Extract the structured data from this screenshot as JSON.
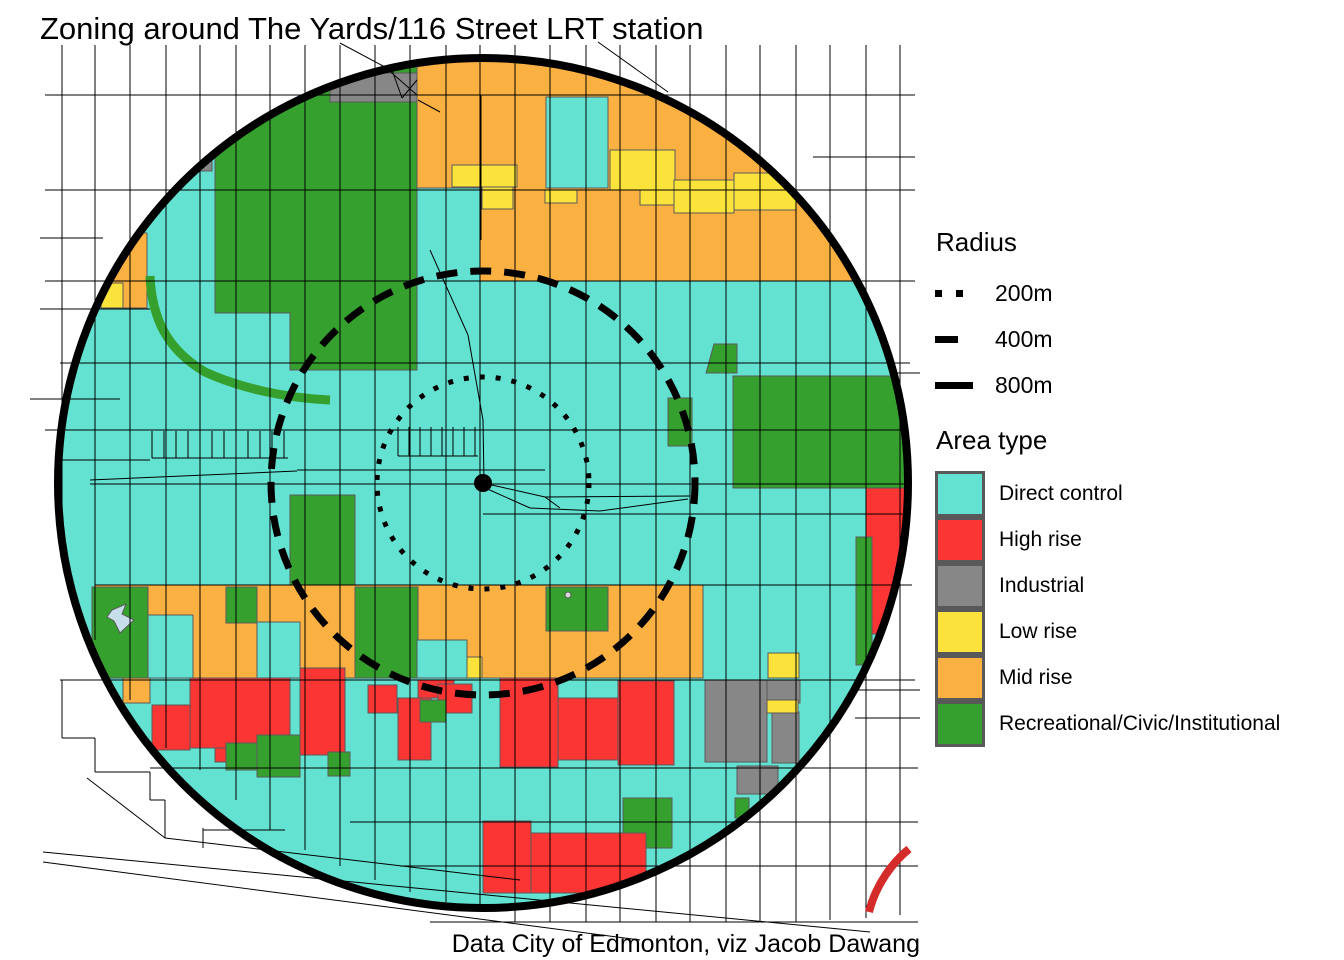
{
  "title": "Zoning around The Yards/116 Street LRT station",
  "caption": "Data City of Edmonton, viz Jacob Dawang",
  "colors": {
    "dc": "#63E2D2",
    "hr": "#FB3434",
    "ind": "#878787",
    "lr": "#FBE33C",
    "mr": "#FBB042",
    "rec": "#36A02F",
    "water": "#C7DFEA",
    "white_dot": "#D9D9D9",
    "red_line": "#D42B2B",
    "parcel_stroke": "#5a5a5a",
    "street": "#000000",
    "ring": "#000000"
  },
  "legend": {
    "radius": {
      "title": "Radius",
      "items": [
        {
          "label": "200m",
          "style": "dotted"
        },
        {
          "label": "400m",
          "style": "dashed"
        },
        {
          "label": "800m",
          "style": "solid"
        }
      ]
    },
    "area_type": {
      "title": "Area type",
      "items": [
        {
          "label": "Direct control",
          "key": "dc"
        },
        {
          "label": "High rise",
          "key": "hr"
        },
        {
          "label": "Industrial",
          "key": "ind"
        },
        {
          "label": "Low rise",
          "key": "lr"
        },
        {
          "label": "Mid rise",
          "key": "mr"
        },
        {
          "label": "Recreational/Civic/Institutional",
          "key": "rec"
        }
      ]
    }
  },
  "map": {
    "center": {
      "x": 483,
      "y": 483
    },
    "rings": [
      {
        "name": "200m",
        "r": 106,
        "w": 5,
        "dash": "5 11"
      },
      {
        "name": "400m",
        "r": 212,
        "w": 7,
        "dash": "21 13"
      },
      {
        "name": "800m",
        "r": 425,
        "w": 8,
        "dash": ""
      }
    ],
    "center_dot_r": 9,
    "base": "dc",
    "parcels": [
      {
        "pts": "215,60 417,60 417,370 290,370 290,313 215,313",
        "c": "rec"
      },
      {
        "r": [
          330,
          73,
          87,
          29
        ],
        "c": "ind"
      },
      {
        "r": [
          196,
          155,
          16,
          16
        ],
        "c": "ind"
      },
      {
        "pts": "101,233 147,233 147,308 123,308 123,283 101,283",
        "c": "mr"
      },
      {
        "r": [
          101,
          283,
          22,
          25
        ],
        "c": "lr"
      },
      {
        "path": "M150,276 C152,320 168,350 205,372 C240,388 285,398 330,400",
        "stroke": "rec",
        "w": 9
      },
      {
        "pts": "417,50 905,50 905,281 480,281 480,188 417,188",
        "c": "mr"
      },
      {
        "r": [
          546,
          97,
          62,
          91
        ],
        "c": "dc"
      },
      {
        "r": [
          452,
          165,
          65,
          22
        ],
        "c": "lr"
      },
      {
        "r": [
          482,
          187,
          31,
          22
        ],
        "c": "lr"
      },
      {
        "r": [
          545,
          190,
          32,
          13
        ],
        "c": "lr"
      },
      {
        "r": [
          610,
          150,
          65,
          40
        ],
        "c": "lr"
      },
      {
        "r": [
          640,
          190,
          35,
          15
        ],
        "c": "lr"
      },
      {
        "r": [
          674,
          180,
          60,
          33
        ],
        "c": "lr"
      },
      {
        "r": [
          734,
          173,
          62,
          37
        ],
        "c": "lr"
      },
      {
        "pts": "714,344 737,344 737,373 706,373",
        "c": "rec"
      },
      {
        "r": [
          733,
          376,
          175,
          112
        ],
        "c": "rec"
      },
      {
        "r": [
          668,
          398,
          24,
          48
        ],
        "c": "rec"
      },
      {
        "r": [
          866,
          488,
          42,
          146
        ],
        "c": "hr"
      },
      {
        "r": [
          856,
          537,
          16,
          128
        ],
        "c": "rec"
      },
      {
        "r": [
          290,
          495,
          65,
          92
        ],
        "c": "rec"
      },
      {
        "r": [
          95,
          585,
          608,
          93
        ],
        "c": "mr"
      },
      {
        "r": [
          92,
          587,
          56,
          91
        ],
        "c": "rec"
      },
      {
        "r": [
          148,
          615,
          45,
          63
        ],
        "c": "dc"
      },
      {
        "r": [
          226,
          587,
          31,
          36
        ],
        "c": "rec"
      },
      {
        "r": [
          257,
          622,
          43,
          56
        ],
        "c": "dc"
      },
      {
        "r": [
          355,
          587,
          63,
          91
        ],
        "c": "rec"
      },
      {
        "r": [
          417,
          640,
          50,
          38
        ],
        "c": "dc"
      },
      {
        "r": [
          467,
          657,
          15,
          21
        ],
        "c": "lr"
      },
      {
        "r": [
          546,
          587,
          62,
          44
        ],
        "c": "rec"
      },
      {
        "r": [
          768,
          653,
          31,
          25
        ],
        "c": "lr"
      },
      {
        "r": [
          123,
          678,
          27,
          25
        ],
        "c": "mr"
      },
      {
        "r": [
          152,
          705,
          38,
          45
        ],
        "c": "hr"
      },
      {
        "r": [
          190,
          678,
          100,
          70
        ],
        "c": "hr"
      },
      {
        "r": [
          215,
          748,
          85,
          14
        ],
        "c": "hr"
      },
      {
        "r": [
          300,
          668,
          45,
          87
        ],
        "c": "hr"
      },
      {
        "r": [
          368,
          685,
          29,
          28
        ],
        "c": "hr"
      },
      {
        "r": [
          398,
          698,
          33,
          62
        ],
        "c": "hr"
      },
      {
        "r": [
          418,
          680,
          36,
          18
        ],
        "c": "hr"
      },
      {
        "r": [
          438,
          684,
          34,
          29
        ],
        "c": "hr"
      },
      {
        "r": [
          500,
          678,
          58,
          89
        ],
        "c": "hr"
      },
      {
        "r": [
          558,
          698,
          60,
          62
        ],
        "c": "hr"
      },
      {
        "r": [
          618,
          681,
          56,
          84
        ],
        "c": "hr"
      },
      {
        "r": [
          226,
          743,
          31,
          27
        ],
        "c": "rec"
      },
      {
        "r": [
          257,
          735,
          43,
          42
        ],
        "c": "rec"
      },
      {
        "r": [
          420,
          700,
          26,
          22
        ],
        "c": "rec"
      },
      {
        "r": [
          328,
          752,
          22,
          24
        ],
        "c": "rec"
      },
      {
        "r": [
          705,
          680,
          62,
          82
        ],
        "c": "ind"
      },
      {
        "r": [
          767,
          680,
          33,
          23
        ],
        "c": "ind"
      },
      {
        "r": [
          772,
          712,
          27,
          51
        ],
        "c": "ind"
      },
      {
        "r": [
          737,
          766,
          41,
          28
        ],
        "c": "ind"
      },
      {
        "r": [
          767,
          700,
          31,
          13
        ],
        "c": "lr"
      },
      {
        "r": [
          623,
          798,
          49,
          50
        ],
        "c": "rec"
      },
      {
        "r": [
          735,
          798,
          14,
          20
        ],
        "c": "rec"
      },
      {
        "r": [
          483,
          821,
          48,
          72
        ],
        "c": "hr"
      },
      {
        "r": [
          531,
          833,
          115,
          60
        ],
        "c": "hr"
      }
    ],
    "water_marker_pts": "112,610 126,604 122,614 134,620 120,633 114,621 107,617",
    "white_dot": [
      568,
      595,
      3
    ],
    "red_curve": "M909,849 C893,862 876,884 869,912",
    "streets": [
      [
        62,
        45,
        62,
        540
      ],
      [
        95,
        45,
        95,
        640
      ],
      [
        130,
        45,
        130,
        700
      ],
      [
        166,
        45,
        166,
        748
      ],
      [
        200,
        45,
        200,
        770
      ],
      [
        236,
        45,
        236,
        800
      ],
      [
        270,
        45,
        270,
        830
      ],
      [
        305,
        45,
        305,
        850
      ],
      [
        340,
        45,
        340,
        866
      ],
      [
        375,
        45,
        375,
        880
      ],
      [
        410,
        45,
        410,
        892
      ],
      [
        446,
        45,
        446,
        902
      ],
      [
        480,
        45,
        480,
        912
      ],
      [
        515,
        45,
        515,
        922
      ],
      [
        550,
        45,
        550,
        922
      ],
      [
        586,
        45,
        586,
        922
      ],
      [
        620,
        45,
        620,
        922
      ],
      [
        656,
        45,
        656,
        922
      ],
      [
        690,
        45,
        690,
        922
      ],
      [
        726,
        45,
        726,
        922
      ],
      [
        760,
        45,
        760,
        922
      ],
      [
        796,
        45,
        796,
        922
      ],
      [
        830,
        45,
        830,
        920
      ],
      [
        866,
        45,
        866,
        918
      ],
      [
        900,
        45,
        900,
        915
      ],
      [
        45,
        95,
        915,
        95
      ],
      [
        45,
        190,
        915,
        190
      ],
      [
        45,
        281,
        915,
        281
      ],
      [
        60,
        363,
        910,
        363
      ],
      [
        45,
        430,
        905,
        430
      ],
      [
        297,
        470,
        545,
        470
      ],
      [
        90,
        480,
        297,
        471
      ],
      [
        90,
        484,
        908,
        484
      ],
      [
        483,
        514,
        906,
        514
      ],
      [
        95,
        585,
        912,
        585
      ],
      [
        60,
        680,
        915,
        680
      ],
      [
        150,
        768,
        918,
        768
      ],
      [
        350,
        822,
        918,
        822
      ],
      [
        400,
        866,
        918,
        866
      ],
      [
        813,
        157,
        915,
        157
      ],
      [
        895,
        373,
        920,
        373
      ],
      [
        858,
        690,
        920,
        690
      ],
      [
        855,
        718,
        920,
        718
      ],
      [
        430,
        922,
        918,
        922
      ],
      [
        40,
        238,
        103,
        238
      ],
      [
        40,
        309,
        150,
        309
      ],
      [
        30,
        399,
        120,
        399
      ],
      [
        60,
        460,
        150,
        460
      ],
      [
        340,
        43,
        385,
        67
      ],
      [
        385,
        67,
        417,
        95
      ],
      [
        392,
        70,
        402,
        98
      ],
      [
        402,
        98,
        417,
        80
      ],
      [
        418,
        100,
        440,
        112
      ],
      [
        598,
        42,
        668,
        92
      ],
      [
        481,
        95,
        481,
        240
      ],
      [
        430,
        250,
        468,
        335
      ],
      [
        468,
        335,
        483,
        420
      ],
      [
        483,
        420,
        484,
        483
      ],
      [
        483,
        483,
        545,
        497
      ],
      [
        545,
        497,
        690,
        496
      ],
      [
        483,
        487,
        530,
        508
      ],
      [
        530,
        508,
        600,
        511
      ],
      [
        600,
        511,
        688,
        499
      ],
      [
        545,
        497,
        560,
        508
      ],
      [
        62,
        680,
        62,
        738
      ],
      [
        62,
        738,
        95,
        738
      ],
      [
        95,
        738,
        95,
        772
      ],
      [
        95,
        772,
        150,
        772
      ],
      [
        150,
        772,
        150,
        800
      ],
      [
        150,
        800,
        165,
        800
      ],
      [
        165,
        800,
        165,
        838
      ],
      [
        87,
        778,
        165,
        838
      ],
      [
        203,
        828,
        203,
        848
      ],
      [
        203,
        830,
        285,
        830
      ],
      [
        43,
        852,
        870,
        932
      ],
      [
        43,
        862,
        640,
        940
      ],
      [
        165,
        838,
        520,
        880
      ],
      [
        152,
        458,
        288,
        458
      ],
      [
        398,
        456,
        478,
        456
      ]
    ],
    "combs": [
      {
        "x0": 152,
        "x1": 288,
        "y0": 431,
        "y1": 458,
        "step": 12
      },
      {
        "x0": 398,
        "x1": 478,
        "y0": 427,
        "y1": 456,
        "step": 11
      }
    ]
  }
}
